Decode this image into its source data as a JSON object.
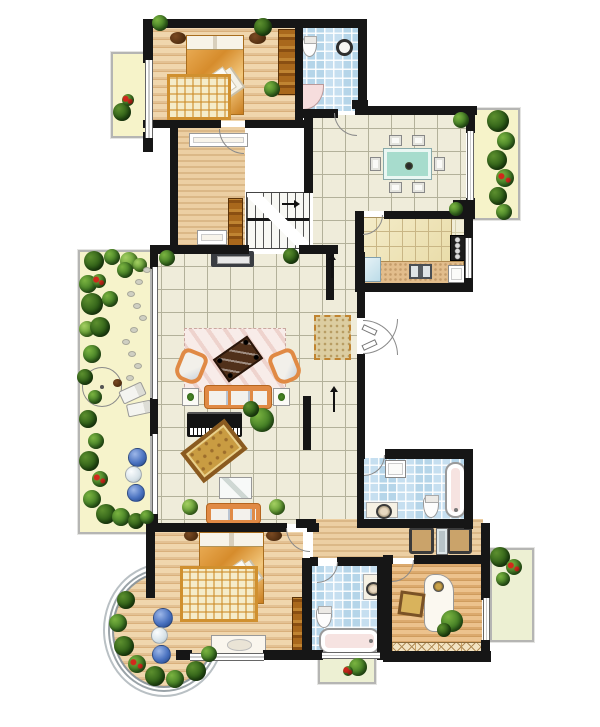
{
  "canvas": {
    "w": 600,
    "h": 727,
    "bg": "#ffffff"
  },
  "palette": {
    "wall": "#161616",
    "tileBg": "#efecda",
    "tileLine": "#b3b19a",
    "woodLight": "#f0d6ad",
    "woodMid": "#e3c193",
    "woodDark": "#d9b07c",
    "blueTile": "#c6dff0",
    "gardenBg": "#f6f3cb",
    "orange": "#e08a45",
    "plantDark": "#2c5c16",
    "accentRed": "#d3281c",
    "sphereBlue": "#4a72c0"
  },
  "floors": [
    {
      "n": "garden-terrace",
      "t": "garden",
      "x": 78,
      "y": 250,
      "w": 74,
      "h": 284,
      "frame": 1
    },
    {
      "n": "balcony-top-left",
      "t": "balcY",
      "x": 111,
      "y": 52,
      "w": 38,
      "h": 86,
      "frame": 1
    },
    {
      "n": "balcony-top-right",
      "t": "balcY",
      "x": 472,
      "y": 108,
      "w": 48,
      "h": 112,
      "frame": 1
    },
    {
      "n": "balcony-study",
      "t": "balcG",
      "x": 490,
      "y": 548,
      "w": 44,
      "h": 94,
      "frame": 1
    },
    {
      "n": "planter-light-well",
      "t": "balcG",
      "x": 318,
      "y": 656,
      "w": 58,
      "h": 28,
      "frame": 1
    },
    {
      "n": "bay-deck",
      "t": "woodA",
      "x": 112,
      "y": 572,
      "w": 104,
      "h": 116,
      "ring": 1
    },
    {
      "n": "bedroom-1",
      "t": "woodA",
      "x": 153,
      "y": 28,
      "w": 143,
      "h": 93
    },
    {
      "n": "bathroom-1",
      "t": "blueT",
      "x": 303,
      "y": 28,
      "w": 56,
      "h": 83
    },
    {
      "n": "hallway",
      "t": "woodB",
      "x": 178,
      "y": 127,
      "w": 67,
      "h": 121
    },
    {
      "n": "dining-room",
      "t": "tile",
      "x": 313,
      "y": 115,
      "w": 153,
      "h": 96
    },
    {
      "n": "corridor",
      "t": "tile",
      "x": 313,
      "y": 115,
      "w": 44,
      "h": 409
    },
    {
      "n": "living-room",
      "t": "tile",
      "x": 158,
      "y": 254,
      "w": 168,
      "h": 270
    },
    {
      "n": "kitchen",
      "t": "tileK",
      "x": 364,
      "y": 219,
      "w": 100,
      "h": 65
    },
    {
      "n": "dressing-area",
      "t": "woodB",
      "x": 313,
      "y": 519,
      "w": 170,
      "h": 39
    },
    {
      "n": "master-bedroom",
      "t": "woodA",
      "x": 155,
      "y": 532,
      "w": 148,
      "h": 120
    },
    {
      "n": "bathroom-2",
      "t": "blueT",
      "x": 312,
      "y": 566,
      "w": 66,
      "h": 85
    },
    {
      "n": "bathroom-3",
      "t": "blueT",
      "x": 362,
      "y": 458,
      "w": 102,
      "h": 62
    },
    {
      "n": "study",
      "t": "woodC",
      "x": 392,
      "y": 564,
      "w": 90,
      "h": 89
    }
  ],
  "walls": [
    [
      143,
      19,
      224,
      9
    ],
    [
      143,
      19,
      10,
      44
    ],
    [
      143,
      132,
      10,
      20
    ],
    [
      143,
      120,
      78,
      8
    ],
    [
      245,
      120,
      62,
      8
    ],
    [
      295,
      24,
      8,
      98
    ],
    [
      358,
      19,
      9,
      84
    ],
    [
      352,
      100,
      16,
      9
    ],
    [
      296,
      109,
      42,
      9
    ],
    [
      355,
      106,
      122,
      9
    ],
    [
      466,
      106,
      9,
      27
    ],
    [
      466,
      198,
      9,
      21
    ],
    [
      453,
      200,
      21,
      19
    ],
    [
      355,
      211,
      9,
      80
    ],
    [
      384,
      211,
      72,
      8
    ],
    [
      464,
      219,
      9,
      73
    ],
    [
      355,
      283,
      118,
      9
    ],
    [
      304,
      109,
      9,
      84
    ],
    [
      170,
      127,
      8,
      122
    ],
    [
      150,
      245,
      99,
      9
    ],
    [
      299,
      245,
      39,
      9
    ],
    [
      150,
      245,
      8,
      24
    ],
    [
      150,
      398,
      8,
      38
    ],
    [
      150,
      512,
      8,
      20
    ],
    [
      326,
      250,
      8,
      50
    ],
    [
      303,
      396,
      8,
      54
    ],
    [
      357,
      252,
      8,
      66
    ],
    [
      357,
      354,
      8,
      100
    ],
    [
      146,
      523,
      141,
      9
    ],
    [
      307,
      523,
      12,
      9
    ],
    [
      146,
      523,
      9,
      75
    ],
    [
      176,
      650,
      16,
      10
    ],
    [
      263,
      650,
      48,
      10
    ],
    [
      302,
      558,
      10,
      102
    ],
    [
      310,
      557,
      8,
      9
    ],
    [
      337,
      557,
      49,
      9
    ],
    [
      377,
      560,
      10,
      100
    ],
    [
      304,
      650,
      19,
      10
    ],
    [
      380,
      650,
      10,
      10
    ],
    [
      357,
      449,
      8,
      10
    ],
    [
      385,
      449,
      88,
      10
    ],
    [
      464,
      449,
      9,
      80
    ],
    [
      357,
      519,
      116,
      9
    ],
    [
      357,
      456,
      7,
      66
    ],
    [
      481,
      523,
      9,
      48
    ],
    [
      481,
      567,
      9,
      33
    ],
    [
      481,
      640,
      9,
      22
    ],
    [
      383,
      556,
      9,
      106
    ],
    [
      383,
      555,
      10,
      9
    ],
    [
      414,
      555,
      76,
      9
    ],
    [
      383,
      651,
      108,
      11
    ],
    [
      296,
      519,
      20,
      9
    ]
  ],
  "windows": [
    {
      "o": "v",
      "x": 145,
      "y": 60,
      "w": 8,
      "h": 78
    },
    {
      "o": "v",
      "x": 467,
      "y": 131,
      "w": 7,
      "h": 69
    },
    {
      "o": "v",
      "x": 152,
      "y": 267,
      "w": 6,
      "h": 132
    },
    {
      "o": "v",
      "x": 152,
      "y": 434,
      "w": 6,
      "h": 80
    },
    {
      "o": "h",
      "x": 190,
      "y": 653,
      "w": 74,
      "h": 8
    },
    {
      "o": "h",
      "x": 322,
      "y": 652,
      "w": 58,
      "h": 7
    },
    {
      "o": "v",
      "x": 483,
      "y": 598,
      "w": 7,
      "h": 42
    },
    {
      "o": "v",
      "x": 465,
      "y": 238,
      "w": 7,
      "h": 40
    }
  ],
  "doors": [
    {
      "c": "bl",
      "x": 219,
      "y": 129,
      "r": 25
    },
    {
      "c": "bl",
      "x": 334,
      "y": 113,
      "r": 23
    },
    {
      "c": "br",
      "x": 363,
      "y": 215,
      "r": 20
    },
    {
      "c": "br",
      "x": 363,
      "y": 319,
      "r": 35
    },
    {
      "c": "tr",
      "x": 363,
      "y": 320,
      "r": 35
    },
    {
      "c": "bl",
      "x": 286,
      "y": 528,
      "r": 24
    },
    {
      "c": "br",
      "x": 317,
      "y": 562,
      "r": 21
    },
    {
      "c": "br",
      "x": 364,
      "y": 455,
      "r": 21
    },
    {
      "c": "br",
      "x": 392,
      "y": 560,
      "r": 22
    }
  ],
  "furniture": [
    {
      "n": "double-bed",
      "t": "bed",
      "x": 186,
      "y": 35,
      "w": 58,
      "h": 80
    },
    {
      "n": "greek-key-rug",
      "t": "rugGreek",
      "x": 167,
      "y": 74,
      "w": 64,
      "h": 46
    },
    {
      "n": "nightstand",
      "t": "tableDark",
      "x": 170,
      "y": 32,
      "w": 16,
      "h": 12
    },
    {
      "n": "nightstand",
      "t": "tableDark",
      "x": 249,
      "y": 32,
      "w": 17,
      "h": 12
    },
    {
      "n": "wardrobe",
      "t": "wardrobeWood",
      "x": 278,
      "y": 29,
      "w": 18,
      "h": 66
    },
    {
      "n": "console-table",
      "t": "consoleWhite",
      "x": 189,
      "y": 133,
      "w": 59,
      "h": 14
    },
    {
      "n": "shoe-cabinet",
      "t": "consoleWhite",
      "x": 197,
      "y": 230,
      "w": 30,
      "h": 15
    },
    {
      "n": "hall-shelf",
      "t": "wardrobeWood",
      "x": 228,
      "y": 198,
      "w": 15,
      "h": 48
    },
    {
      "n": "staircase",
      "t": "stairs",
      "x": 246,
      "y": 192,
      "w": 64,
      "h": 57
    },
    {
      "n": "toilet",
      "t": "toiletS",
      "x": 302,
      "y": 36,
      "w": 15,
      "h": 21
    },
    {
      "n": "wash-basin",
      "t": "sinkRound",
      "x": 336,
      "y": 39,
      "w": 17,
      "h": 17
    },
    {
      "n": "corner-shower",
      "t": "showerCorner",
      "x": 301,
      "y": 84,
      "w": 23,
      "h": 26
    },
    {
      "n": "dining-table",
      "t": "tableTeal",
      "x": 384,
      "y": 149,
      "w": 47,
      "h": 30
    },
    {
      "n": "dining-chair",
      "t": "chairWhite",
      "x": 389,
      "y": 135,
      "w": 13,
      "h": 11
    },
    {
      "n": "dining-chair",
      "t": "chairWhite",
      "x": 412,
      "y": 135,
      "w": 13,
      "h": 11
    },
    {
      "n": "dining-chair",
      "t": "chairWhite",
      "x": 389,
      "y": 182,
      "w": 13,
      "h": 11
    },
    {
      "n": "dining-chair",
      "t": "chairWhite",
      "x": 412,
      "y": 182,
      "w": 13,
      "h": 11
    },
    {
      "n": "dining-chair",
      "t": "chairWhite",
      "x": 370,
      "y": 157,
      "w": 11,
      "h": 14
    },
    {
      "n": "dining-chair",
      "t": "chairWhite",
      "x": 434,
      "y": 157,
      "w": 11,
      "h": 14
    },
    {
      "n": "kitchen-cabinets",
      "t": "cabinetGrid",
      "x": 362,
      "y": 217,
      "w": 90,
      "h": 46
    },
    {
      "n": "kitchen-counter",
      "t": "counterTan",
      "x": 362,
      "y": 261,
      "w": 102,
      "h": 23
    },
    {
      "n": "refrigerator",
      "t": "fridge",
      "x": 362,
      "y": 257,
      "w": 19,
      "h": 25
    },
    {
      "n": "kitchen-sink",
      "t": "sinkK",
      "x": 409,
      "y": 264,
      "w": 23,
      "h": 15
    },
    {
      "n": "stove",
      "t": "stove",
      "x": 450,
      "y": 235,
      "w": 15,
      "h": 26
    },
    {
      "n": "kitchen-cabinet",
      "t": "whiteBox",
      "x": 448,
      "y": 265,
      "w": 17,
      "h": 18
    },
    {
      "n": "doormat",
      "t": "mat",
      "x": 314,
      "y": 315,
      "w": 37,
      "h": 45
    },
    {
      "n": "entry-door-leaf",
      "t": "leaf",
      "x": 362,
      "y": 327,
      "w": 15,
      "h": 6,
      "rot": 25
    },
    {
      "n": "entry-door-leaf",
      "t": "leaf",
      "x": 362,
      "y": 342,
      "w": 15,
      "h": 6,
      "rot": -25
    },
    {
      "n": "tv-cabinet",
      "t": "tvCab",
      "x": 211,
      "y": 251,
      "w": 43,
      "h": 16
    },
    {
      "n": "living-rug",
      "t": "rugPink",
      "x": 184,
      "y": 328,
      "w": 102,
      "h": 64
    },
    {
      "n": "coffee-table",
      "t": "tableCoffee",
      "x": 217,
      "y": 345,
      "w": 42,
      "h": 28,
      "rot": -35
    },
    {
      "n": "armchair",
      "t": "armchair",
      "x": 177,
      "y": 350,
      "w": 28,
      "h": 33,
      "rot": 22
    },
    {
      "n": "armchair",
      "t": "armchair",
      "x": 271,
      "y": 350,
      "w": 28,
      "h": 33,
      "rot": -22
    },
    {
      "n": "sofa",
      "t": "sofa",
      "x": 204,
      "y": 385,
      "w": 68,
      "h": 24
    },
    {
      "n": "side-table",
      "t": "sideTable",
      "x": 182,
      "y": 388,
      "w": 17,
      "h": 18
    },
    {
      "n": "side-table",
      "t": "sideTable",
      "x": 273,
      "y": 388,
      "w": 17,
      "h": 18
    },
    {
      "n": "piano",
      "t": "piano",
      "x": 187,
      "y": 412,
      "w": 55,
      "h": 25
    },
    {
      "n": "ornate-rug",
      "t": "rugOrnate",
      "x": 186,
      "y": 432,
      "w": 56,
      "h": 38,
      "rot": -38
    },
    {
      "n": "glass-table",
      "t": "glassTable",
      "x": 219,
      "y": 477,
      "w": 33,
      "h": 22
    },
    {
      "n": "bench-sofa",
      "t": "sofa",
      "x": 206,
      "y": 503,
      "w": 55,
      "h": 21
    },
    {
      "n": "parasol",
      "t": "parasol",
      "x": 82,
      "y": 367,
      "w": 40,
      "h": 40
    },
    {
      "n": "lounge-chair",
      "t": "lounger",
      "x": 120,
      "y": 386,
      "w": 25,
      "h": 14,
      "rot": -25
    },
    {
      "n": "lounge-chair",
      "t": "lounger",
      "x": 127,
      "y": 402,
      "w": 25,
      "h": 13,
      "rot": -12
    },
    {
      "n": "garden-table",
      "t": "tableDark",
      "x": 113,
      "y": 379,
      "w": 9,
      "h": 8
    },
    {
      "n": "double-bed",
      "t": "bed",
      "x": 199,
      "y": 532,
      "w": 65,
      "h": 72
    },
    {
      "n": "greek-key-rug",
      "t": "rugGreek",
      "x": 180,
      "y": 566,
      "w": 78,
      "h": 56
    },
    {
      "n": "nightstand",
      "t": "tableDark",
      "x": 184,
      "y": 530,
      "w": 14,
      "h": 11
    },
    {
      "n": "nightstand",
      "t": "tableDark",
      "x": 266,
      "y": 530,
      "w": 16,
      "h": 11
    },
    {
      "n": "dresser",
      "t": "dresserWhite",
      "x": 211,
      "y": 635,
      "w": 55,
      "h": 19
    },
    {
      "n": "wardrobe",
      "t": "wardrobeWood",
      "x": 292,
      "y": 597,
      "w": 17,
      "h": 60
    },
    {
      "n": "toilet",
      "t": "toiletS",
      "x": 316,
      "y": 606,
      "w": 16,
      "h": 22
    },
    {
      "n": "bathtub",
      "t": "tubH",
      "x": 319,
      "y": 628,
      "w": 61,
      "h": 26
    },
    {
      "n": "vanity-basin",
      "t": "sinkCounter",
      "x": 363,
      "y": 574,
      "w": 17,
      "h": 26
    },
    {
      "n": "washer",
      "t": "whiteBox",
      "x": 385,
      "y": 460,
      "w": 21,
      "h": 18
    },
    {
      "n": "bathtub",
      "t": "tubV",
      "x": 445,
      "y": 462,
      "w": 21,
      "h": 56
    },
    {
      "n": "toilet",
      "t": "toiletS",
      "x": 423,
      "y": 495,
      "w": 16,
      "h": 23
    },
    {
      "n": "vanity-basin",
      "t": "sinkCounter2",
      "x": 366,
      "y": 502,
      "w": 32,
      "h": 16
    },
    {
      "n": "dressing-chair",
      "t": "chairDark",
      "x": 409,
      "y": 527,
      "w": 25,
      "h": 27
    },
    {
      "n": "dressing-chair",
      "t": "chairDark",
      "x": 447,
      "y": 527,
      "w": 25,
      "h": 27
    },
    {
      "n": "vanity-mirror",
      "t": "mirror",
      "x": 436,
      "y": 528,
      "w": 12,
      "h": 27
    },
    {
      "n": "desk",
      "t": "desk",
      "x": 424,
      "y": 574,
      "w": 30,
      "h": 58
    },
    {
      "n": "picture-frame",
      "t": "frameSq",
      "x": 399,
      "y": 592,
      "w": 25,
      "h": 24,
      "rot": 8
    },
    {
      "n": "bookshelf",
      "t": "bookshelfX",
      "x": 391,
      "y": 642,
      "w": 91,
      "h": 15
    }
  ],
  "plants": [
    [
      160,
      23,
      8,
      "m"
    ],
    [
      263,
      27,
      9,
      "d"
    ],
    [
      272,
      89,
      8,
      "m"
    ],
    [
      461,
      120,
      8,
      "m"
    ],
    [
      456,
      209,
      7,
      "m"
    ],
    [
      498,
      121,
      11,
      "d"
    ],
    [
      506,
      141,
      9,
      "m"
    ],
    [
      497,
      160,
      10,
      "d"
    ],
    [
      505,
      178,
      9,
      "r"
    ],
    [
      498,
      196,
      9,
      "d"
    ],
    [
      504,
      212,
      8,
      "m"
    ],
    [
      122,
      112,
      9,
      "d"
    ],
    [
      128,
      100,
      6,
      "r"
    ],
    [
      167,
      258,
      8,
      "m"
    ],
    [
      291,
      256,
      8,
      "d"
    ],
    [
      262,
      420,
      12,
      "m"
    ],
    [
      251,
      409,
      8,
      "d"
    ],
    [
      190,
      507,
      8,
      "l"
    ],
    [
      277,
      507,
      8,
      "l"
    ],
    [
      94,
      261,
      10,
      "d"
    ],
    [
      112,
      257,
      8,
      "m"
    ],
    [
      129,
      261,
      9,
      "l"
    ],
    [
      88,
      284,
      9,
      "m"
    ],
    [
      99,
      281,
      7,
      "r"
    ],
    [
      92,
      304,
      11,
      "d"
    ],
    [
      110,
      299,
      8,
      "m"
    ],
    [
      87,
      329,
      8,
      "l"
    ],
    [
      100,
      327,
      10,
      "d"
    ],
    [
      92,
      354,
      9,
      "m"
    ],
    [
      85,
      377,
      8,
      "d"
    ],
    [
      95,
      397,
      7,
      "m"
    ],
    [
      88,
      419,
      9,
      "d"
    ],
    [
      96,
      441,
      8,
      "m"
    ],
    [
      89,
      461,
      10,
      "d"
    ],
    [
      100,
      479,
      8,
      "r"
    ],
    [
      92,
      499,
      9,
      "m"
    ],
    [
      106,
      514,
      10,
      "d"
    ],
    [
      121,
      517,
      9,
      "m"
    ],
    [
      136,
      521,
      8,
      "d"
    ],
    [
      147,
      517,
      7,
      "m"
    ],
    [
      125,
      270,
      8,
      "m"
    ],
    [
      140,
      265,
      7,
      "l"
    ],
    [
      126,
      600,
      9,
      "d"
    ],
    [
      118,
      623,
      9,
      "m"
    ],
    [
      124,
      646,
      10,
      "d"
    ],
    [
      137,
      664,
      9,
      "r"
    ],
    [
      155,
      676,
      10,
      "d"
    ],
    [
      175,
      679,
      9,
      "m"
    ],
    [
      196,
      671,
      10,
      "d"
    ],
    [
      209,
      654,
      8,
      "m"
    ],
    [
      358,
      667,
      9,
      "m"
    ],
    [
      348,
      671,
      5,
      "r"
    ],
    [
      500,
      557,
      10,
      "d"
    ],
    [
      514,
      567,
      8,
      "r"
    ],
    [
      503,
      579,
      7,
      "m"
    ],
    [
      452,
      621,
      11,
      "m"
    ],
    [
      444,
      630,
      7,
      "d"
    ]
  ],
  "spheres": [
    [
      128,
      448,
      19,
      "b"
    ],
    [
      125,
      466,
      17,
      "w"
    ],
    [
      127,
      484,
      18,
      "b"
    ],
    [
      153,
      608,
      20,
      "b"
    ],
    [
      151,
      627,
      17,
      "w"
    ],
    [
      152,
      645,
      19,
      "b"
    ]
  ],
  "stones": [
    [
      143,
      267
    ],
    [
      135,
      279
    ],
    [
      127,
      291
    ],
    [
      133,
      303
    ],
    [
      139,
      315
    ],
    [
      130,
      327
    ],
    [
      122,
      339
    ],
    [
      128,
      351
    ],
    [
      134,
      363
    ],
    [
      126,
      375
    ]
  ],
  "arrows": [
    {
      "x": 331,
      "y": 258,
      "h": 20,
      "d": "up"
    },
    {
      "x": 333,
      "y": 390,
      "h": 22,
      "d": "up"
    },
    {
      "x": 294,
      "y": 203,
      "h": 14,
      "d": "right"
    }
  ]
}
